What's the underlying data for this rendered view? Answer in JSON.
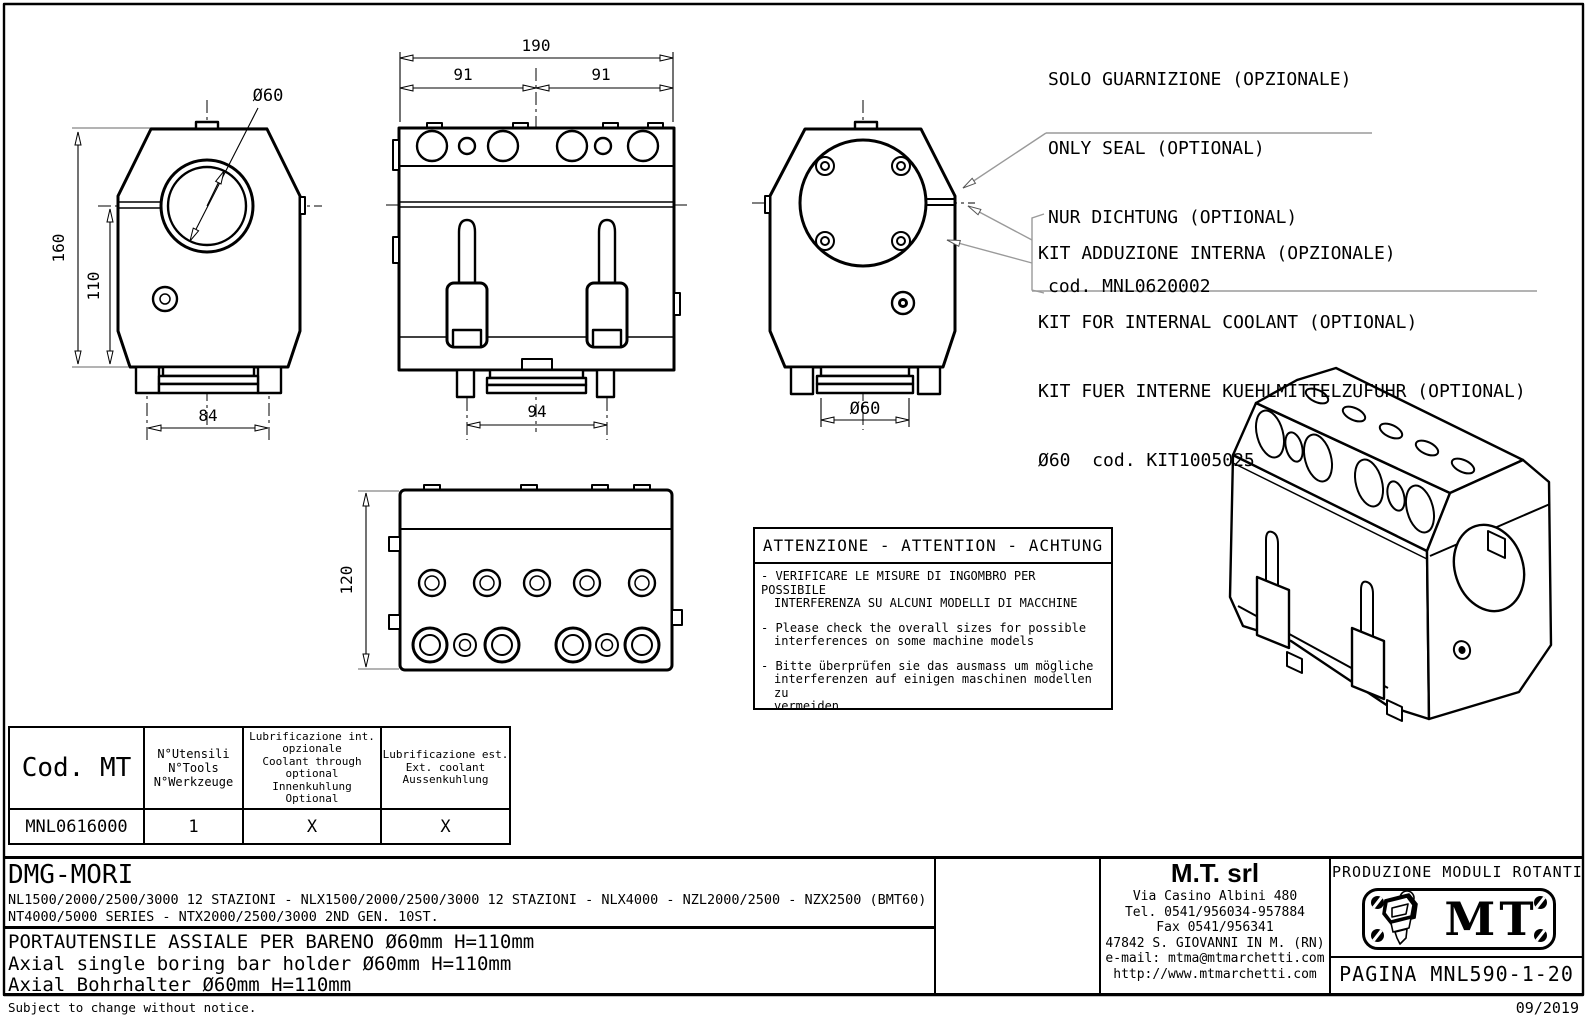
{
  "colors": {
    "ink": "#000000",
    "dim_gray": "#9a9a9a",
    "background": "#ffffff"
  },
  "notes": {
    "seal": {
      "line1": "SOLO GUARNIZIONE (OPZIONALE)",
      "line2": "ONLY SEAL (OPTIONAL)",
      "line3": "NUR DICHTUNG (OPTIONAL)",
      "line4": "cod. MNL0620002"
    },
    "coolant": {
      "line1": "KIT ADDUZIONE INTERNA (OPZIONALE)",
      "line2": "KIT FOR INTERNAL COOLANT (OPTIONAL)",
      "line3": "KIT FUER INTERNE KUEHLMITTELZUFUHR (OPTIONAL)",
      "line4": "Ø60  cod. KIT1005025"
    }
  },
  "dims": {
    "total_width": "190",
    "half_left": "91",
    "half_right": "91",
    "height": "160",
    "bore_height": "110",
    "base_width": "84",
    "clamp_pitch": "94",
    "bore": "Ø60",
    "base_dia": "Ø60",
    "depth": "120"
  },
  "attention": {
    "title": "ATTENZIONE - ATTENTION - ACHTUNG",
    "items": [
      {
        "l1": "- VERIFICARE LE MISURE DI INGOMBRO PER POSSIBILE",
        "l2": "INTERFERENZA SU ALCUNI MODELLI DI MACCHINE"
      },
      {
        "l1": "- Please check the overall sizes for possible",
        "l2": "interferences on some machine models"
      },
      {
        "l1": "- Bitte überprüfen sie das ausmass um mögliche",
        "l2": "interferenzen auf einigen maschinen modellen zu",
        "l3": "vermeiden"
      }
    ]
  },
  "table": {
    "col1_header": "Cod. MT",
    "col2_header": {
      "l1": "N°Utensili",
      "l2": "N°Tools",
      "l3": "N°Werkzeuge"
    },
    "col3_header": {
      "l1": "Lubrificazione int.",
      "l2": "opzionale",
      "l3": "Coolant through",
      "l4": "optional",
      "l5": "Innenkuhlung",
      "l6": "Optional"
    },
    "col4_header": {
      "l1": "Lubrificazione est.",
      "l2": "Ext. coolant",
      "l3": "Aussenkuhlung"
    },
    "row": {
      "code": "MNL0616000",
      "tools": "1",
      "coolant_int": "X",
      "coolant_ext": "X"
    }
  },
  "title_block": {
    "brand": "DMG-MORI",
    "models_line1": "NL1500/2000/2500/3000 12 STAZIONI - NLX1500/2000/2500/3000 12 STAZIONI - NLX4000 - NZL2000/2500 - NZX2500 (BMT60)",
    "models_line2": "NT4000/5000 SERIES - NTX2000/2500/3000 2ND GEN. 10ST.",
    "title_it": "PORTAUTENSILE ASSIALE PER BARENO Ø60mm H=110mm",
    "title_en": "Axial single boring bar holder Ø60mm H=110mm",
    "title_de": "Axial Bohrhalter Ø60mm H=110mm"
  },
  "company": {
    "name": "M.T. srl",
    "line1": "Via Casino Albini 480",
    "line2": "Tel. 0541/956034-957884",
    "line3": "Fax 0541/956341",
    "line4": "47842 S. GIOVANNI IN M. (RN)",
    "line5": "e-mail: mtma@mtmarchetti.com",
    "line6": "http://www.mtmarchetti.com"
  },
  "producer": {
    "header": "PRODUZIONE MODULI ROTANTI",
    "logo_text": "MT",
    "page_label": "PAGINA MNL590-1-20"
  },
  "footer": {
    "left": "Subject to change without notice.",
    "right": "09/2019"
  }
}
